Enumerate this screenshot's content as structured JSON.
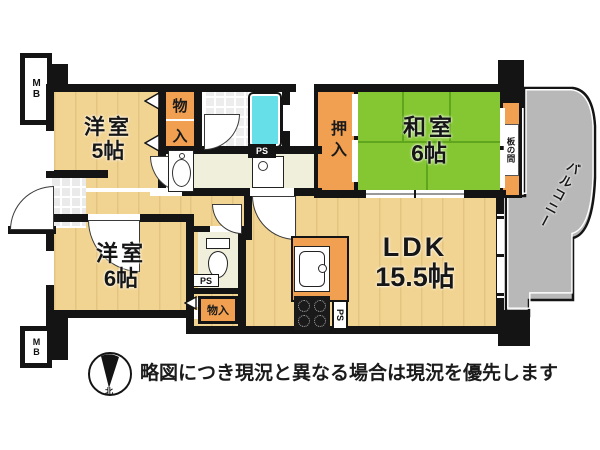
{
  "plan": {
    "rooms": {
      "yoshitsu5": {
        "name": "洋室",
        "size": "5帖"
      },
      "yoshitsu6": {
        "name": "洋室",
        "size": "6帖"
      },
      "washitsu": {
        "name": "和室",
        "size": "6帖"
      },
      "ldk": {
        "name": "LDK",
        "size": "15.5帖"
      },
      "oshiire": {
        "label": "押入"
      },
      "monoiri_top": {
        "char1": "物",
        "char2": "入"
      },
      "monoiri_bottom": {
        "label": "物入"
      },
      "itanoma": {
        "label": "板の間"
      },
      "balcony": {
        "label": "バルコニー"
      }
    },
    "labels": {
      "mb_top": "MB",
      "mb_bottom": "MB",
      "ps_bath": "PS",
      "ps_toilet": "PS",
      "ps_kitchen": "PS"
    },
    "compass": {
      "north": "北"
    }
  },
  "footer": {
    "disclaimer": "略図につき現況と異なる場合は現況を優先します"
  },
  "colors": {
    "floor_beige": "#F2D492",
    "tatami_green": "#85C732",
    "closet_orange": "#F0A050",
    "balcony_gray": "#B8B8B8",
    "bathtub_cyan": "#66DFE8",
    "washroom_cream": "#F0EFDB",
    "wall_black": "#141414"
  }
}
